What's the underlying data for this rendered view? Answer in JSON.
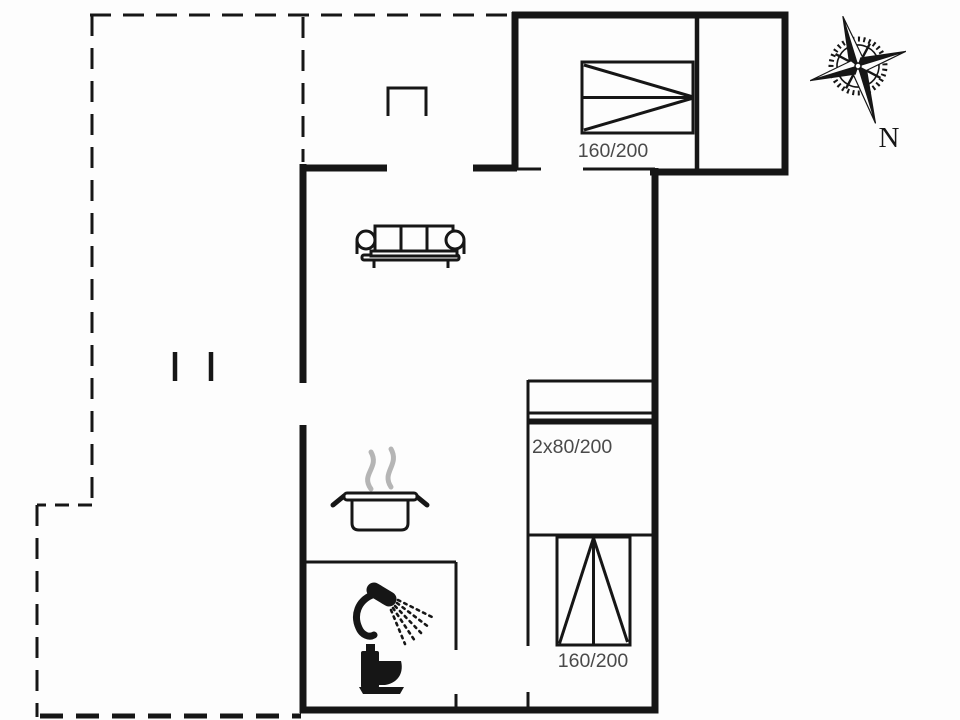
{
  "title": "holiday-home-floor-plan",
  "labels": {
    "bedroom_top_bed": "160/200",
    "bunk_bed": "2x80/200",
    "bedroom_bottom_bed": "160/200",
    "compass_north": "N"
  },
  "icons": {
    "sofa": "three-seat-sofa",
    "cooking_pot": "pot-with-steam",
    "shower": "shower-head-with-spray",
    "toilet": "toilet-silhouette",
    "compass": "compass-rose",
    "chimney": "open-rectangle-symbol"
  },
  "colors": {
    "line": "#161616",
    "label_text": "#4a4a4a",
    "steam": "#b5b5b5",
    "background": "#fdfdfd"
  }
}
